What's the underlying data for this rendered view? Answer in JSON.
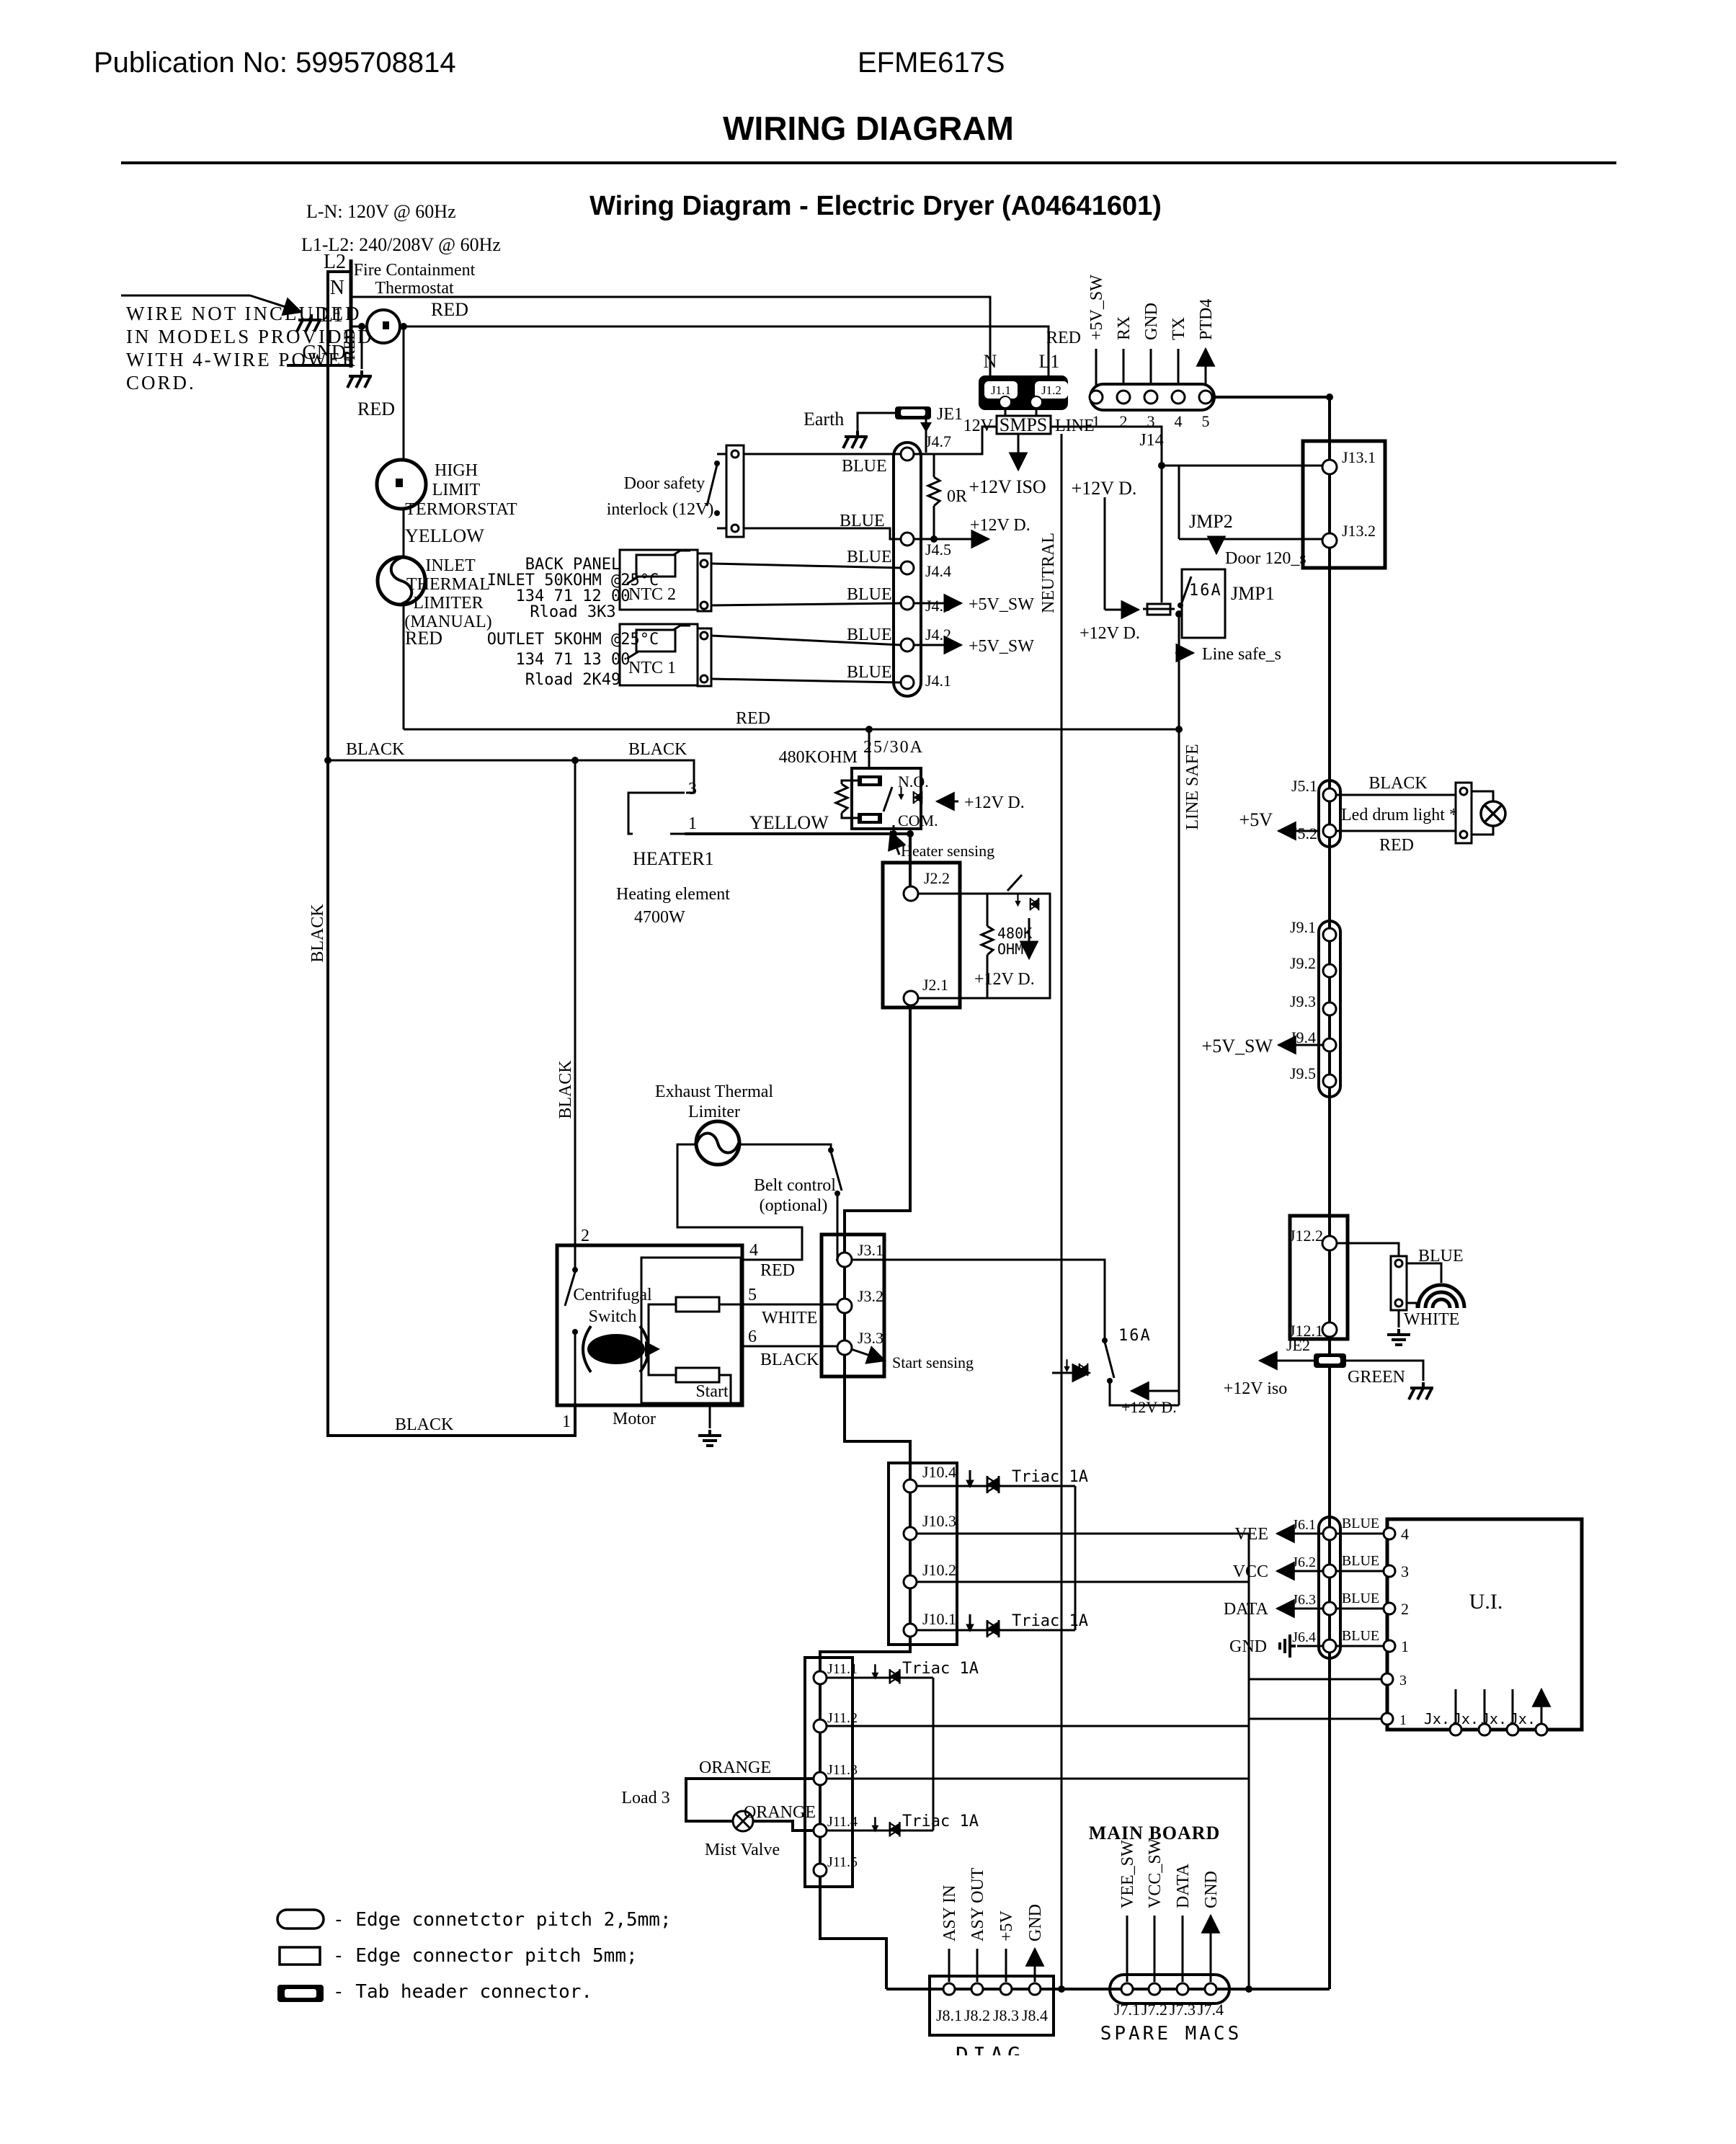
{
  "header": {
    "publication": "Publication No: 5995708814",
    "model": "EFME617S",
    "title": "WIRING DIAGRAM"
  },
  "diagram": {
    "title": "Wiring Diagram - Electric Dryer (A04641601)",
    "main_board": "MAIN BOARD",
    "spare_macs": "SPARE MACS",
    "diag": "DIAG"
  },
  "com": {
    "red": "RED",
    "black": "BLACK",
    "blue": "BLUE",
    "yellow": "YELLOW",
    "white": "WHITE",
    "green": "GREEN",
    "orange": "ORANGE",
    "d12": "+12V D.",
    "iso12": "+12V ISO",
    "sw5": "+5V_SW",
    "v5": "+5V",
    "a16": "16A",
    "triac": "Triac 1A"
  },
  "power": {
    "ln": "L-N: 120V @ 60Hz",
    "l1l2": "L1-L2: 240/208V @ 60Hz",
    "l2": "L2",
    "n": "N",
    "l1": "L1",
    "gnd": "GND",
    "earth": "Earth",
    "note1": "WIRE NOT INCLUDED",
    "note2": "IN MODELS PROVIDED",
    "note3": "WITH 4-WIRE POWER",
    "note4": "CORD.",
    "fire1": "Fire Containment",
    "fire2": "Thermostat"
  },
  "chain": {
    "hl1": "HIGH",
    "hl2": "LIMIT",
    "hl3": "TERMORSTAT",
    "in1": "INLET",
    "in2": "THERMAL",
    "in3": "LIMITER",
    "in4": "(MANUAL)"
  },
  "ntc": {
    "door1": "Door safety",
    "door2": "interlock (12V)",
    "bp1": "BACK PANEL",
    "bp2": "INLET 50KOHM @25°C",
    "bp3": "134 71 12 00",
    "bp4": "Rload 3K3",
    "ntc2": "NTC 2",
    "out1": "OUTLET 5KOHM @25°C",
    "out2": "134 71 13 00",
    "out3": "Rload 2K49",
    "ntc1": "NTC 1"
  },
  "smps": {
    "label": "SMPS",
    "v12": "12V",
    "line": "LINE",
    "neutral": "NEUTRAL"
  },
  "j1": {
    "j11": "J1.1",
    "j12": "J1.2",
    "n": "N",
    "l1": "L1",
    "je1": "JE1"
  },
  "j14": {
    "label": "J14",
    "pins": [
      "1",
      "2",
      "3",
      "4",
      "5"
    ],
    "signals": [
      "+5V_SW",
      "RX",
      "GND",
      "TX",
      "PTD4"
    ]
  },
  "j4": {
    "j47": "J4.7",
    "j45": "J4.5",
    "j44": "J4.4",
    "j43": "J4.3",
    "j42": "J4.2",
    "j41": "J4.1",
    "r0": "0R"
  },
  "j13": {
    "j131": "J13.1",
    "j132": "J13.2",
    "jmp2": "JMP2",
    "jmp1": "JMP1",
    "door120": "Door 120_s",
    "linesafe_s": "Line safe_s",
    "linesafe": "LINE SAFE"
  },
  "heater": {
    "kohm": "480KOHM",
    "amps": "25/30A",
    "no": "N.O.",
    "com": "COM.",
    "sensing": "Heater sensing",
    "p3": "3",
    "p1": "1",
    "name": "HEATER1",
    "elem": "Heating element",
    "watt": "4700W"
  },
  "j2": {
    "j22": "J2.2",
    "j21": "J2.1",
    "k480": "480K",
    "ohm": "OHM"
  },
  "j5": {
    "j51": "J5.1",
    "j52": "J5.2",
    "led": "Led drum light *"
  },
  "j9": {
    "j91": "J9.1",
    "j92": "J9.2",
    "j93": "J9.3",
    "j94": "J9.4",
    "j95": "J9.5"
  },
  "motor": {
    "exh1": "Exhaust Thermal",
    "exh2": "Limiter",
    "belt1": "Belt control",
    "belt2": "(optional)",
    "cent1": "Centrifugal",
    "cent2": "Switch",
    "start": "Start",
    "name": "Motor",
    "p1": "1",
    "p2": "2",
    "p4": "4",
    "p5": "5",
    "p6": "6"
  },
  "j3": {
    "j31": "J3.1",
    "j32": "J3.2",
    "j33": "J3.3",
    "sensing": "Start sensing"
  },
  "j12": {
    "j122": "J12.2",
    "j121": "J12.1",
    "je2": "JE2",
    "iso": "+12V iso"
  },
  "j10": {
    "j104": "J10.4",
    "j103": "J10.3",
    "j102": "J10.2",
    "j101": "J10.1"
  },
  "j11": {
    "j111": "J11.1",
    "j112": "J11.2",
    "j113": "J11.3",
    "j114": "J11.4",
    "j115": "J11.5",
    "load3": "Load 3",
    "mist": "Mist Valve"
  },
  "j6": {
    "j61": "J6.1",
    "j62": "J6.2",
    "j63": "J6.3",
    "j64": "J6.4",
    "vee": "VEE",
    "vcc": "VCC",
    "data": "DATA",
    "gnd": "GND",
    "ui": "U.I.",
    "p4": "4",
    "p3": "3",
    "p2": "2",
    "p1": "1",
    "p3b": "3",
    "p1b": "1",
    "jx1": "Jx.",
    "jx2": "Jx.",
    "jx3": "Jx.",
    "jx4": "Jx."
  },
  "j7": {
    "j71": "J7.1",
    "j72": "J7.2",
    "j73": "J7.3",
    "j74": "J7.4",
    "vee": "VEE_SW",
    "vcc": "VCC_SW",
    "data": "DATA",
    "gnd": "GND"
  },
  "j8": {
    "j81": "J8.1",
    "j82": "J8.2",
    "j83": "J8.3",
    "j84": "J8.4",
    "asy_in": "ASY IN",
    "asy_out": "ASY OUT",
    "v5": "+5V",
    "gnd": "GND"
  },
  "legend": {
    "e25": "- Edge connetctor pitch 2,5mm;",
    "e5": "- Edge connector pitch 5mm;",
    "tab": "- Tab header connector."
  }
}
